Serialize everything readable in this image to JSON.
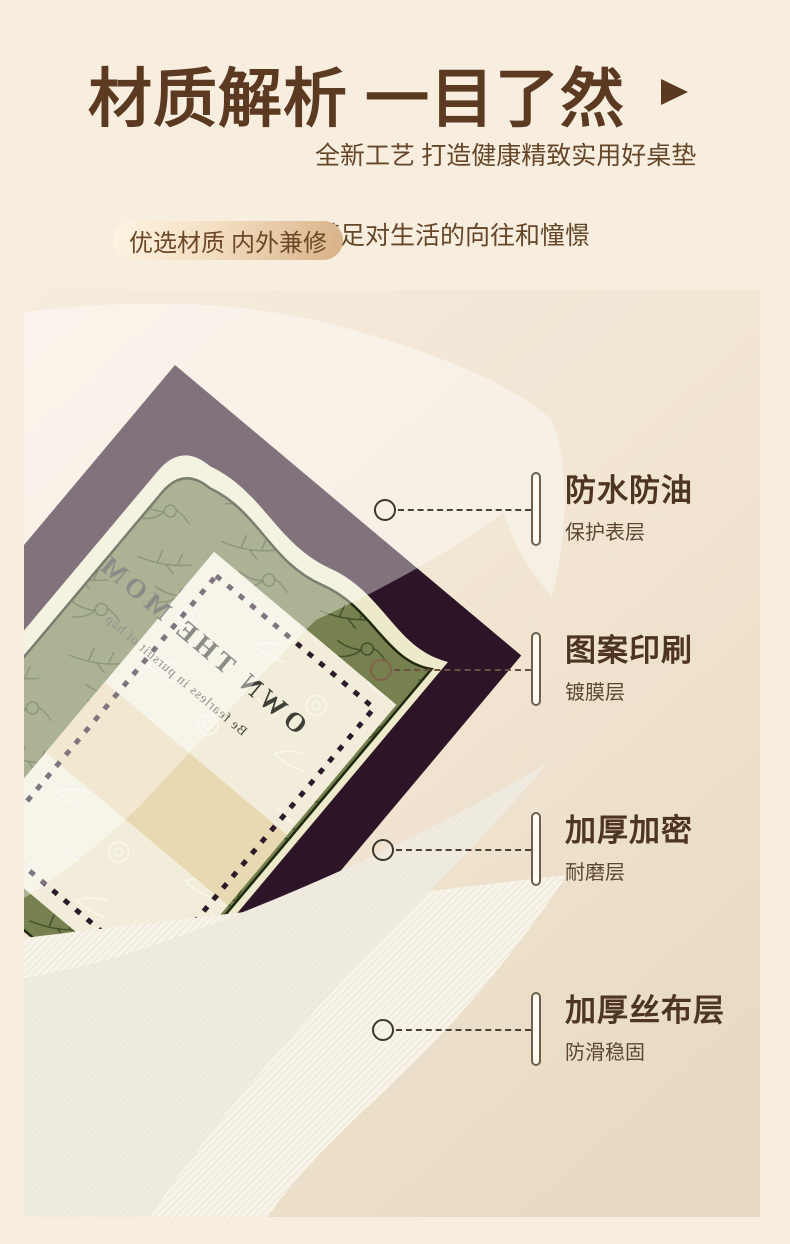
{
  "page": {
    "background": "#f8eedf"
  },
  "header": {
    "title": "材质解析 一目了然",
    "arrow_icon": "right-triangle-arrow",
    "subtitle_line1": "全新工艺 打造健康精致实用好桌垫",
    "subtitle_line2": "满足对生活的向往和憧憬",
    "badge_label": "优选材质 内外兼修"
  },
  "callouts": [
    {
      "title": "防水防油",
      "subtitle": "保护表层"
    },
    {
      "title": "图案印刷",
      "subtitle": "镀膜层"
    },
    {
      "title": "加厚加密",
      "subtitle": "耐磨层"
    },
    {
      "title": "加厚丝布层",
      "subtitle": "防滑稳固"
    }
  ],
  "mat": {
    "text_line1": "OWN THE MOM",
    "text_line2": "Be fearless in pursuit of hap"
  },
  "colors": {
    "accent_brown": "#5b3a21",
    "callout_title_brown": "#4d3521",
    "badge_gradient_start": "#fef4e4",
    "badge_gradient_end": "#d7b086",
    "mat_plum": "#2d1426",
    "mat_green": "#76814f",
    "mat_border_cream": "#edeacb",
    "panel_cream": "#f2edda",
    "panel_band_beige": "#e8d8b0",
    "photo_bg_top": "#f6ecdf",
    "photo_bg_bottom": "#e8dcc6"
  }
}
